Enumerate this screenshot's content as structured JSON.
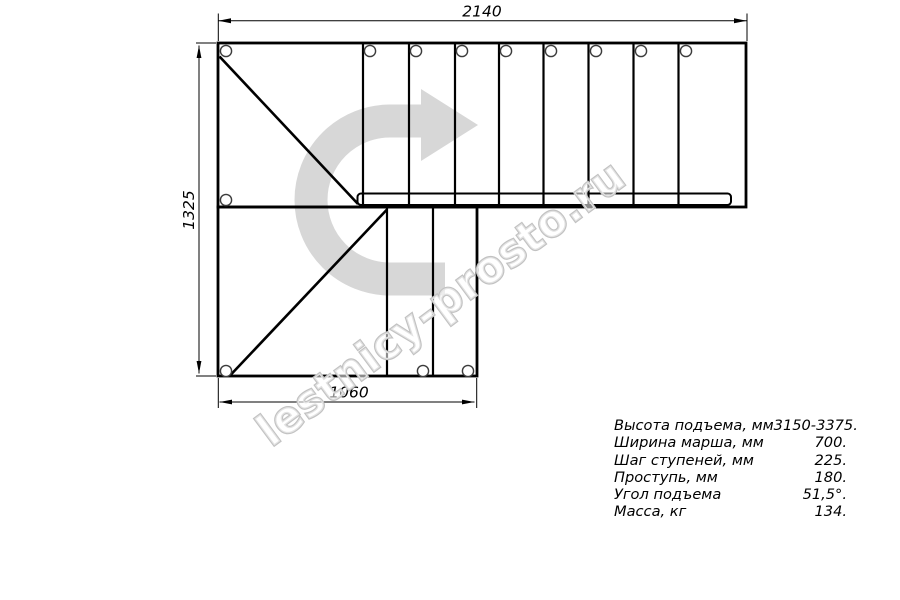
{
  "watermark": {
    "text": "lestnicy-prosto.ru"
  },
  "drawing": {
    "dimensions": {
      "top": "2140",
      "left": "1325",
      "bottom": "1060"
    }
  },
  "specs": {
    "rows": [
      {
        "label": "Высота подъема, мм",
        "value": "3150-3375."
      },
      {
        "label": "Ширина марша, мм",
        "value": "700."
      },
      {
        "label": "Шаг ступеней, мм",
        "value": "225."
      },
      {
        "label": "Проступь, мм",
        "value": "180."
      },
      {
        "label": "Угол подъема",
        "value": "51,5°."
      },
      {
        "label": "Масса, кг",
        "value": "134."
      }
    ]
  },
  "colors": {
    "line": "#000000",
    "arrow": "#d7d7d7",
    "watermark": "#c2c2c2",
    "background": "#ffffff"
  }
}
